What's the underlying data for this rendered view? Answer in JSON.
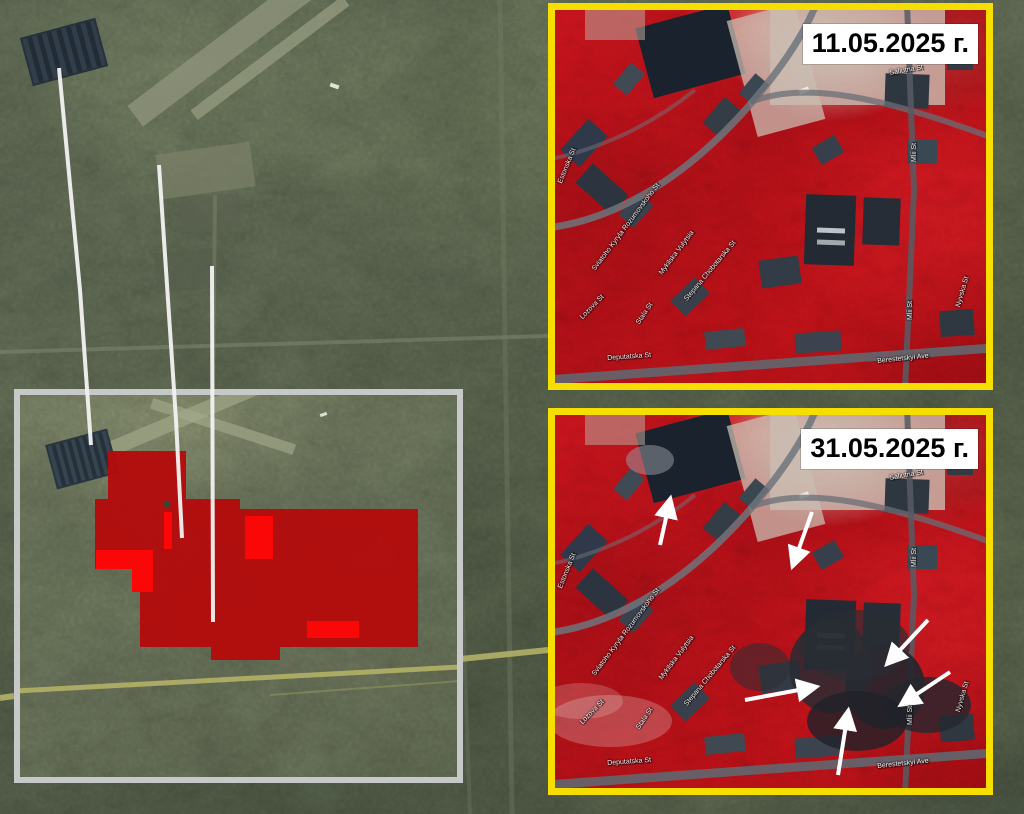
{
  "figure": {
    "description_visible_text_only": true
  },
  "panels": {
    "before": {
      "date_label": "11.05.2025 г."
    },
    "after": {
      "date_label": "31.05.2025 г."
    }
  },
  "street_labels": [
    {
      "text": "Saliutna St",
      "x": 334,
      "y": 60,
      "rot": -10
    },
    {
      "text": "Mlii St",
      "x": 356,
      "y": 152,
      "rot": -90
    },
    {
      "text": "Mlii St",
      "x": 352,
      "y": 310,
      "rot": -90
    },
    {
      "text": "Nyvska St",
      "x": 400,
      "y": 296,
      "rot": -74
    },
    {
      "text": "Berestetskyi Ave",
      "x": 322,
      "y": 348,
      "rot": -6
    },
    {
      "text": "Sviatoho Kyryla Rozumovskoho St",
      "x": 36,
      "y": 258,
      "rot": -53
    },
    {
      "text": "Mykilska Vulytsia",
      "x": 103,
      "y": 262,
      "rot": -53
    },
    {
      "text": "Stepana Chobotarska St",
      "x": 128,
      "y": 288,
      "rot": -50
    },
    {
      "text": "Lozova St",
      "x": 24,
      "y": 306,
      "rot": -46
    },
    {
      "text": "Stala St",
      "x": 80,
      "y": 312,
      "rot": -56
    },
    {
      "text": "Deputatska St",
      "x": 52,
      "y": 345,
      "rot": -4
    },
    {
      "text": "Estonska St",
      "x": 2,
      "y": 172,
      "rot": -68
    }
  ],
  "annotations": {
    "arrows": [
      {
        "x1": 105,
        "y1": 130,
        "x2": 115,
        "y2": 85
      },
      {
        "x1": 257,
        "y1": 97,
        "x2": 238,
        "y2": 150
      },
      {
        "x1": 373,
        "y1": 205,
        "x2": 333,
        "y2": 248
      },
      {
        "x1": 190,
        "y1": 285,
        "x2": 260,
        "y2": 272
      },
      {
        "x1": 283,
        "y1": 360,
        "x2": 293,
        "y2": 297
      },
      {
        "x1": 395,
        "y1": 257,
        "x2": 347,
        "y2": 289
      }
    ],
    "leader_lines": [
      {
        "points": "59,68 80,290 91,445"
      },
      {
        "points": "159,165 176,420 182,538"
      },
      {
        "points": "212,266 213,622"
      }
    ],
    "damage_overlay": {
      "path": "M88,56 H166 V104 H220 V114 H398 V252 H260 V265 H191 V252 H120 V197 H112 V174 H75 V104 H88 Z",
      "bright_patches": [
        {
          "x": 76,
          "y": 155,
          "w": 57,
          "h": 19
        },
        {
          "x": 112,
          "y": 174,
          "w": 21,
          "h": 23
        },
        {
          "x": 225,
          "y": 121,
          "w": 28,
          "h": 43
        },
        {
          "x": 287,
          "y": 226,
          "w": 52,
          "h": 17
        },
        {
          "x": 144,
          "y": 117,
          "w": 8,
          "h": 37
        }
      ],
      "hole_dot": {
        "x": 147,
        "y": 109,
        "r": 3.5
      }
    }
  },
  "colors": {
    "panel_border": "#f6df00",
    "inset_border": "#c7c9c8",
    "damage_dark": "#b30c0c",
    "damage_bright": "#fa0707",
    "arrow": "#ffffff",
    "leader_line": "#f2f2f2",
    "date_bg": "#ffffff",
    "date_text": "#000000"
  }
}
